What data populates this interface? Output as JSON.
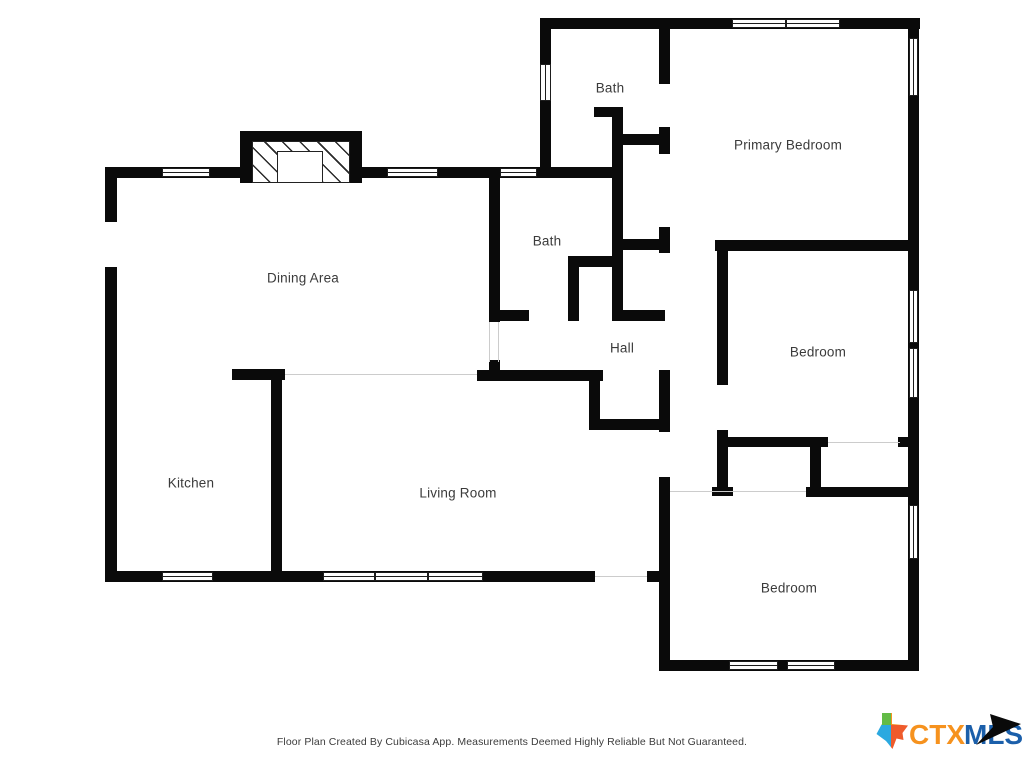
{
  "page": {
    "background": "#ffffff",
    "wall_color": "#0a0a0a",
    "label_color": "#3b3b3b"
  },
  "footer": {
    "disclaimer": "Floor Plan Created By Cubicasa App. Measurements Deemed Highly Reliable But Not Guaranteed."
  },
  "logo": {
    "ctx": "CTX",
    "mls": "MLS",
    "ctx_color": "#F6921E",
    "mls_color": "#1B5FAA",
    "arrow_color": "#0a0a0a",
    "texas_colors": {
      "tl": "#62BB46",
      "tr": "#F6921E",
      "bl": "#2BA9E0",
      "br": "#EF5B2B"
    }
  },
  "floorplan": {
    "rooms": [
      {
        "label": "Bath",
        "cx": 610,
        "cy": 88
      },
      {
        "label": "Primary Bedroom",
        "cx": 788,
        "cy": 145
      },
      {
        "label": "Dining Area",
        "cx": 303,
        "cy": 278
      },
      {
        "label": "Bath",
        "cx": 547,
        "cy": 241
      },
      {
        "label": "Hall",
        "cx": 622,
        "cy": 348
      },
      {
        "label": "Bedroom",
        "cx": 818,
        "cy": 352
      },
      {
        "label": "Kitchen",
        "cx": 191,
        "cy": 483
      },
      {
        "label": "Living Room",
        "cx": 458,
        "cy": 493
      },
      {
        "label": "Bedroom",
        "cx": 789,
        "cy": 588
      }
    ],
    "walls": [
      [
        540,
        18,
        380,
        11
      ],
      [
        540,
        18,
        11,
        156
      ],
      [
        908,
        18,
        11,
        653
      ],
      [
        659,
        18,
        11,
        66
      ],
      [
        659,
        127,
        11,
        27
      ],
      [
        621,
        134,
        40,
        11
      ],
      [
        594,
        107,
        28,
        10
      ],
      [
        612,
        107,
        11,
        214
      ],
      [
        489,
        167,
        134,
        11
      ],
      [
        105,
        167,
        135,
        11
      ],
      [
        362,
        167,
        128,
        11
      ],
      [
        105,
        167,
        12,
        55
      ],
      [
        105,
        267,
        12,
        315
      ],
      [
        489,
        167,
        11,
        155
      ],
      [
        489,
        360,
        11,
        15
      ],
      [
        568,
        256,
        52,
        11
      ],
      [
        568,
        256,
        11,
        65
      ],
      [
        489,
        310,
        40,
        11
      ],
      [
        612,
        310,
        53,
        11
      ],
      [
        621,
        239,
        49,
        11
      ],
      [
        659,
        227,
        11,
        26
      ],
      [
        715,
        240,
        195,
        11
      ],
      [
        717,
        240,
        11,
        145
      ],
      [
        717,
        430,
        11,
        65
      ],
      [
        712,
        487,
        21,
        9
      ],
      [
        717,
        437,
        111,
        10
      ],
      [
        898,
        437,
        12,
        10
      ],
      [
        810,
        437,
        11,
        56
      ],
      [
        806,
        487,
        104,
        10
      ],
      [
        659,
        370,
        11,
        62
      ],
      [
        659,
        477,
        11,
        194
      ],
      [
        659,
        660,
        260,
        11
      ],
      [
        477,
        370,
        126,
        11
      ],
      [
        589,
        377,
        11,
        53
      ],
      [
        589,
        419,
        79,
        11
      ],
      [
        232,
        369,
        53,
        11
      ],
      [
        271,
        369,
        11,
        213
      ],
      [
        105,
        571,
        490,
        11
      ],
      [
        647,
        571,
        13,
        11
      ]
    ],
    "windows": [
      {
        "x": 732,
        "y": 19,
        "w": 54,
        "h": 9,
        "o": "h"
      },
      {
        "x": 786,
        "y": 19,
        "w": 54,
        "h": 9,
        "o": "h"
      },
      {
        "x": 162,
        "y": 168,
        "w": 48,
        "h": 9,
        "o": "h"
      },
      {
        "x": 387,
        "y": 168,
        "w": 51,
        "h": 9,
        "o": "h"
      },
      {
        "x": 500,
        "y": 168,
        "w": 37,
        "h": 9,
        "o": "h"
      },
      {
        "x": 162,
        "y": 572,
        "w": 51,
        "h": 9,
        "o": "h"
      },
      {
        "x": 323,
        "y": 572,
        "w": 52,
        "h": 9,
        "o": "h"
      },
      {
        "x": 375,
        "y": 572,
        "w": 53,
        "h": 9,
        "o": "h"
      },
      {
        "x": 428,
        "y": 572,
        "w": 55,
        "h": 9,
        "o": "h"
      },
      {
        "x": 729,
        "y": 661,
        "w": 49,
        "h": 9,
        "o": "h"
      },
      {
        "x": 787,
        "y": 661,
        "w": 48,
        "h": 9,
        "o": "h"
      },
      {
        "x": 540,
        "y": 64,
        "w": 11,
        "h": 37,
        "o": "v"
      },
      {
        "x": 909,
        "y": 38,
        "w": 9,
        "h": 58,
        "o": "v"
      },
      {
        "x": 909,
        "y": 290,
        "w": 9,
        "h": 53,
        "o": "v"
      },
      {
        "x": 909,
        "y": 348,
        "w": 9,
        "h": 50,
        "o": "v"
      },
      {
        "x": 909,
        "y": 505,
        "w": 9,
        "h": 54,
        "o": "v"
      }
    ],
    "openings": [
      [
        285,
        374,
        192,
        1
      ],
      [
        595,
        576,
        52,
        1
      ],
      [
        670,
        491,
        136,
        1
      ],
      [
        828,
        442,
        72,
        1
      ],
      [
        489,
        322,
        1,
        40
      ],
      [
        498,
        322,
        1,
        40
      ]
    ],
    "fireplace": {
      "top": [
        240,
        131,
        122,
        11
      ],
      "left": [
        240,
        131,
        12,
        52
      ],
      "right": [
        350,
        131,
        12,
        52
      ],
      "hatch": [
        252,
        141,
        98,
        42
      ],
      "firebox": [
        277,
        151,
        46,
        32
      ]
    }
  }
}
